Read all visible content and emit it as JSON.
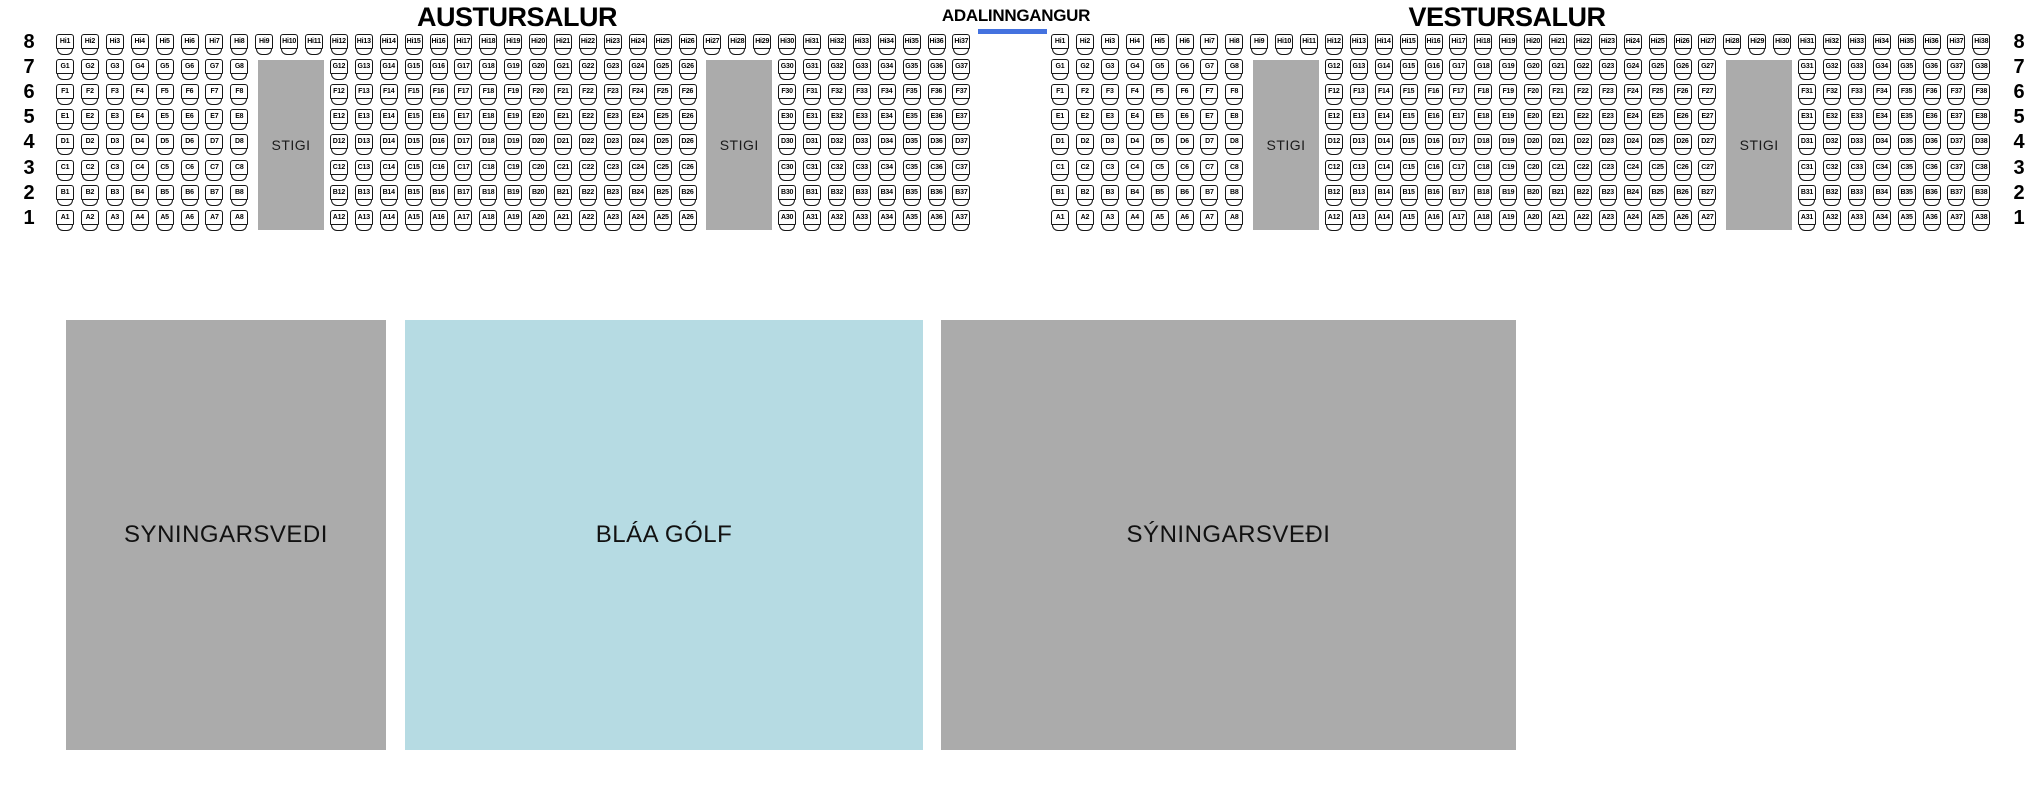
{
  "entrance": {
    "label": "ADALINNGANGUR",
    "bar_color": "#4472DF"
  },
  "stairs_label": "STIGI",
  "colors": {
    "stairs": "#ABABAB",
    "exhibition_gray": "#ABABAB",
    "blue_floor": "#B6DBE3",
    "seat_border": "#161616"
  },
  "halls": [
    {
      "name": "AUSTURSALUR",
      "rows": [
        {
          "row_number": "8",
          "letter": "Hi",
          "seat_ranges": [
            [
              1,
              37
            ]
          ]
        },
        {
          "row_number": "7",
          "letter": "G",
          "seat_ranges": [
            [
              1,
              8
            ],
            [
              12,
              26
            ],
            [
              30,
              37
            ]
          ]
        },
        {
          "row_number": "6",
          "letter": "F",
          "seat_ranges": [
            [
              1,
              8
            ],
            [
              12,
              26
            ],
            [
              30,
              37
            ]
          ]
        },
        {
          "row_number": "5",
          "letter": "E",
          "seat_ranges": [
            [
              1,
              8
            ],
            [
              12,
              26
            ],
            [
              30,
              37
            ]
          ]
        },
        {
          "row_number": "4",
          "letter": "D",
          "seat_ranges": [
            [
              1,
              8
            ],
            [
              12,
              26
            ],
            [
              30,
              37
            ]
          ]
        },
        {
          "row_number": "3",
          "letter": "C",
          "seat_ranges": [
            [
              1,
              8
            ],
            [
              12,
              26
            ],
            [
              30,
              37
            ]
          ]
        },
        {
          "row_number": "2",
          "letter": "B",
          "seat_ranges": [
            [
              1,
              8
            ],
            [
              12,
              26
            ],
            [
              30,
              37
            ]
          ]
        },
        {
          "row_number": "1",
          "letter": "A",
          "seat_ranges": [
            [
              1,
              8
            ],
            [
              12,
              26
            ],
            [
              30,
              37
            ]
          ]
        }
      ],
      "stairs": [
        {
          "label": "STIGI",
          "columns": [
            9,
            11
          ]
        },
        {
          "label": "STIGI",
          "columns": [
            27,
            29
          ]
        }
      ]
    },
    {
      "name": "VESTURSALUR",
      "rows": [
        {
          "row_number": "8",
          "letter": "Hi",
          "seat_ranges": [
            [
              1,
              38
            ]
          ]
        },
        {
          "row_number": "7",
          "letter": "G",
          "seat_ranges": [
            [
              1,
              8
            ],
            [
              12,
              27
            ],
            [
              31,
              38
            ]
          ]
        },
        {
          "row_number": "6",
          "letter": "F",
          "seat_ranges": [
            [
              1,
              8
            ],
            [
              12,
              27
            ],
            [
              31,
              38
            ]
          ]
        },
        {
          "row_number": "5",
          "letter": "E",
          "seat_ranges": [
            [
              1,
              8
            ],
            [
              12,
              27
            ],
            [
              31,
              38
            ]
          ]
        },
        {
          "row_number": "4",
          "letter": "D",
          "seat_ranges": [
            [
              1,
              8
            ],
            [
              12,
              27
            ],
            [
              31,
              38
            ]
          ]
        },
        {
          "row_number": "3",
          "letter": "C",
          "seat_ranges": [
            [
              1,
              8
            ],
            [
              12,
              27
            ],
            [
              31,
              38
            ]
          ]
        },
        {
          "row_number": "2",
          "letter": "B",
          "seat_ranges": [
            [
              1,
              8
            ],
            [
              12,
              27
            ],
            [
              31,
              38
            ]
          ]
        },
        {
          "row_number": "1",
          "letter": "A",
          "seat_ranges": [
            [
              1,
              8
            ],
            [
              12,
              27
            ],
            [
              31,
              38
            ]
          ]
        }
      ],
      "stairs": [
        {
          "label": "STIGI",
          "columns": [
            9,
            11
          ]
        },
        {
          "label": "STIGI",
          "columns": [
            28,
            30
          ]
        }
      ]
    }
  ],
  "areas": [
    {
      "label": "SYNINGARSVEDI",
      "color": "#ABABAB"
    },
    {
      "label": "BLÁA GÓLF",
      "color": "#B6DBE3"
    },
    {
      "label": "SÝNINGARSVEÐI",
      "color": "#ABABAB"
    }
  ]
}
